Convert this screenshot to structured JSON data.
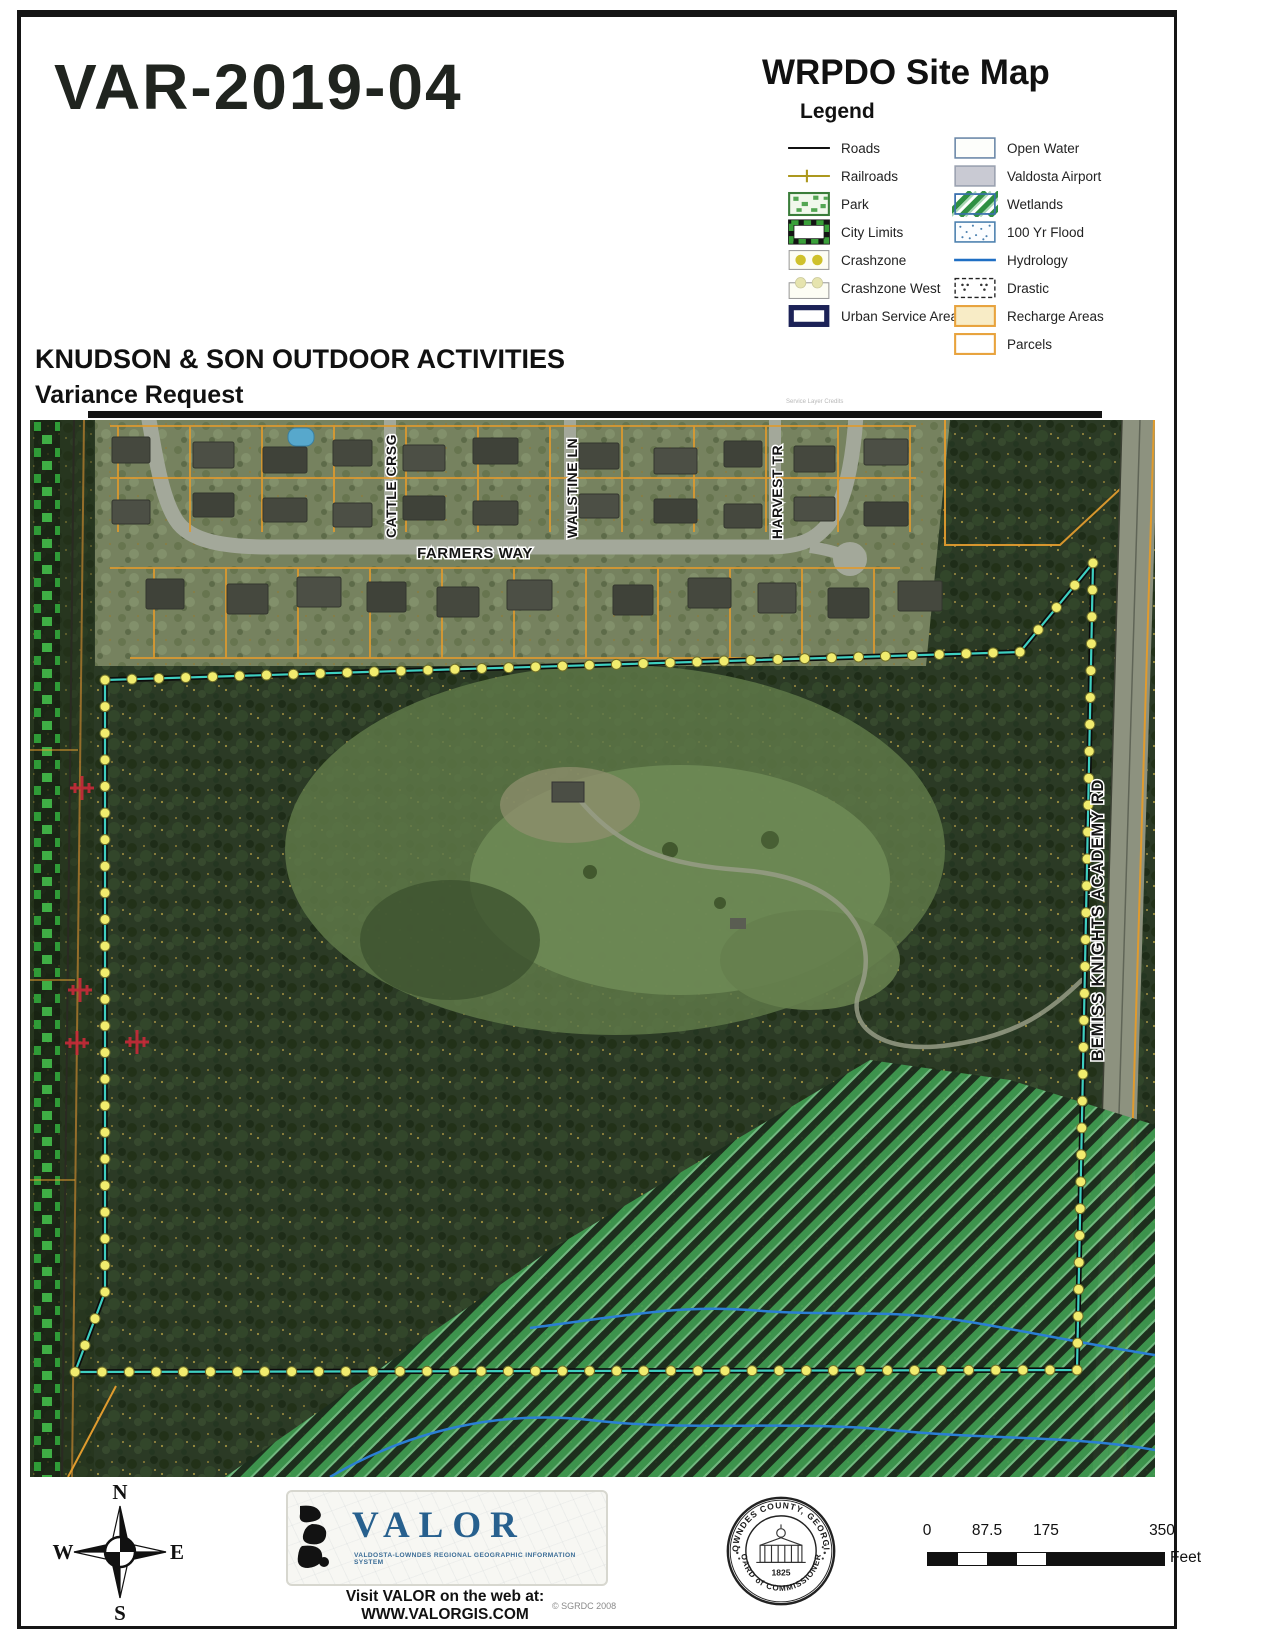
{
  "header": {
    "case_number": "VAR-2019-04",
    "map_title": "WRPDO Site Map",
    "legend_title": "Legend",
    "project_name": "KNUDSON & SON OUTDOOR ACTIVITIES",
    "project_subtitle": "Variance Request",
    "service_credits": "Service Layer Credits"
  },
  "legend": {
    "left": [
      {
        "label": "Roads"
      },
      {
        "label": "Railroads"
      },
      {
        "label": "Park"
      },
      {
        "label": "City Limits"
      },
      {
        "label": "Crashzone"
      },
      {
        "label": "Crashzone West"
      },
      {
        "label": "Urban Service Area"
      }
    ],
    "right": [
      {
        "label": "Open Water"
      },
      {
        "label": "Valdosta Airport"
      },
      {
        "label": "Wetlands"
      },
      {
        "label": "100 Yr Flood"
      },
      {
        "label": "Hydrology"
      },
      {
        "label": "Drastic"
      },
      {
        "label": "Recharge Areas"
      },
      {
        "label": "Parcels"
      }
    ]
  },
  "map": {
    "street_labels": {
      "farmers_way": "FARMERS WAY",
      "cattle_crsg": "CATTLE CRSG",
      "walstine_ln": "WALSTINE LN",
      "harvest_tr": "HARVEST TR",
      "bemiss_knights_academy_rd": "BEMISS KNIGHTS ACADEMY RD"
    }
  },
  "footer": {
    "compass": {
      "north": "N",
      "east": "E",
      "south": "S",
      "west": "W"
    },
    "valor": {
      "name": "VALOR",
      "tagline": "VALDOSTA-LOWNDES REGIONAL GEOGRAPHIC INFORMATION SYSTEM",
      "website_line": "Visit VALOR on the web at: WWW.VALORGIS.COM",
      "copyright": "© SGRDC 2008"
    },
    "seal": {
      "arc_top": "LOWNDES COUNTY, GEORGIA",
      "arc_bottom": "BOARD of COMMISSIONERS",
      "year": "1825"
    },
    "scale_bar": {
      "ticks": [
        "0",
        "87.5",
        "175",
        "350"
      ],
      "unit": "Feet"
    }
  },
  "colors": {
    "boundary_teal": "#3ecfc0",
    "boundary_dot_yellow": "#f1ec6e",
    "parcel_orange": "#e09b2e",
    "wetland_green": "#3f9b50",
    "hydrology_blue": "#2b7fd4",
    "crossing_red": "#c62a38",
    "urban_service_navy": "#1c2257",
    "city_limits_green": "#3aa03a",
    "valor_blue": "#27608e"
  }
}
